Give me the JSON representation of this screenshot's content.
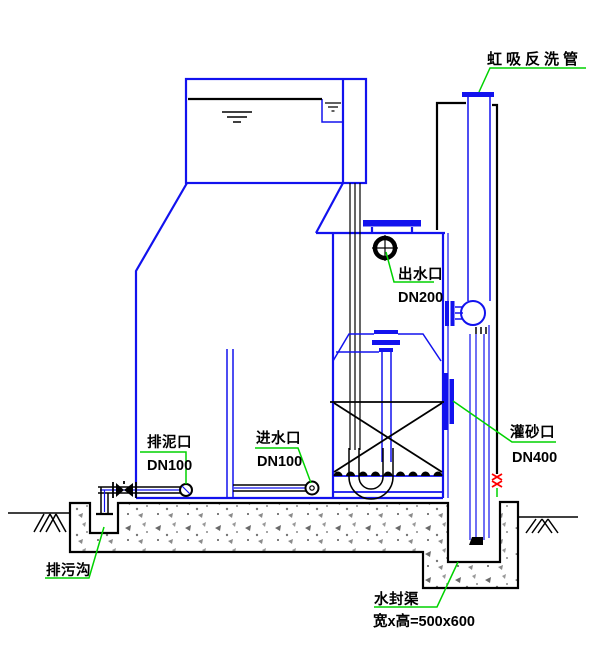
{
  "diagram": {
    "kind": "valveless-gravity-filter-cross-section",
    "labels": {
      "siphon_backwash": {
        "text": "虹吸反洗管"
      },
      "outlet": {
        "text": "出水口",
        "size": "DN200"
      },
      "sludge_port": {
        "text": "排泥口",
        "size": "DN100"
      },
      "inlet": {
        "text": "进水口",
        "size": "DN100"
      },
      "sand_fill_port": {
        "text": "灌砂口",
        "size": "DN400"
      },
      "drain_ditch": {
        "text": "排污沟"
      },
      "water_seal": {
        "text": "水封渠",
        "dimension": "宽x高=500x600"
      }
    },
    "colors": {
      "line_blue": "#1212ee",
      "leader_green": "#00d200",
      "break_red": "#ff0000",
      "line_black": "#000000",
      "background": "#ffffff"
    }
  }
}
